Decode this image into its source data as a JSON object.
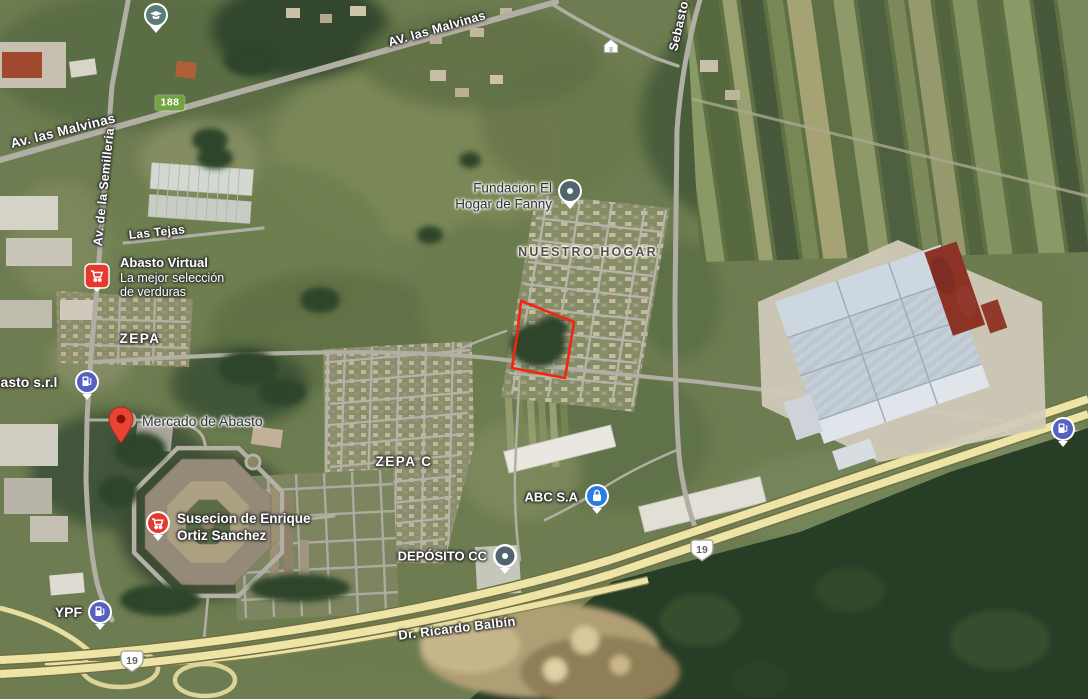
{
  "view": {
    "type": "satellite-map-view"
  },
  "colors": {
    "shield_green": "#73a440",
    "parcel_outline": "#f3250f",
    "gas_pin_blue": "#5560c0",
    "lock_pin_blue": "#2a7de1",
    "poi_pin_slate": "#54646d",
    "school_pin_teal": "#5b7d78",
    "marker_red": "#ea4335",
    "marker_red_dark": "#8c1007",
    "cart_badge_red": "#e6392d",
    "highway_yellow": "#eee4a6"
  },
  "roads": {
    "av_las_malvinas_upper": "AV. las Malvinas",
    "av_las_malvinas_lower": "Av. las Malvinas",
    "av_de_la_semilleria": "Av. de la Semilleria",
    "las_tejas": "Las Tejas",
    "sebasto": "Sebasto",
    "dr_ricardo_balbin": "Dr. Ricardo Balbín"
  },
  "routes": {
    "r188": "188",
    "r19": "19"
  },
  "areas": {
    "nuestro_hogar": "NUESTRO HOGAR",
    "zepa": "ZEPA",
    "zepa_c": "ZEPA C"
  },
  "places": {
    "fundacion": {
      "line1": "Fundación El",
      "line2": "Hogar de Fanny"
    },
    "abasto_virtual": {
      "title": "Abasto Virtual",
      "sub1": "La mejor selección",
      "sub2": "de verduras"
    },
    "abasto_srl": {
      "title": "basto s.r.l"
    },
    "mercado": {
      "title": "Mercado de Abasto"
    },
    "susecion": {
      "line1": "Susecion de Enrique",
      "line2": "Ortiz Sanchez"
    },
    "abc": {
      "title": "ABC S.A"
    },
    "deposito": {
      "title": "DEPÓSITO CC"
    },
    "ypf": {
      "title": "YPF"
    }
  }
}
